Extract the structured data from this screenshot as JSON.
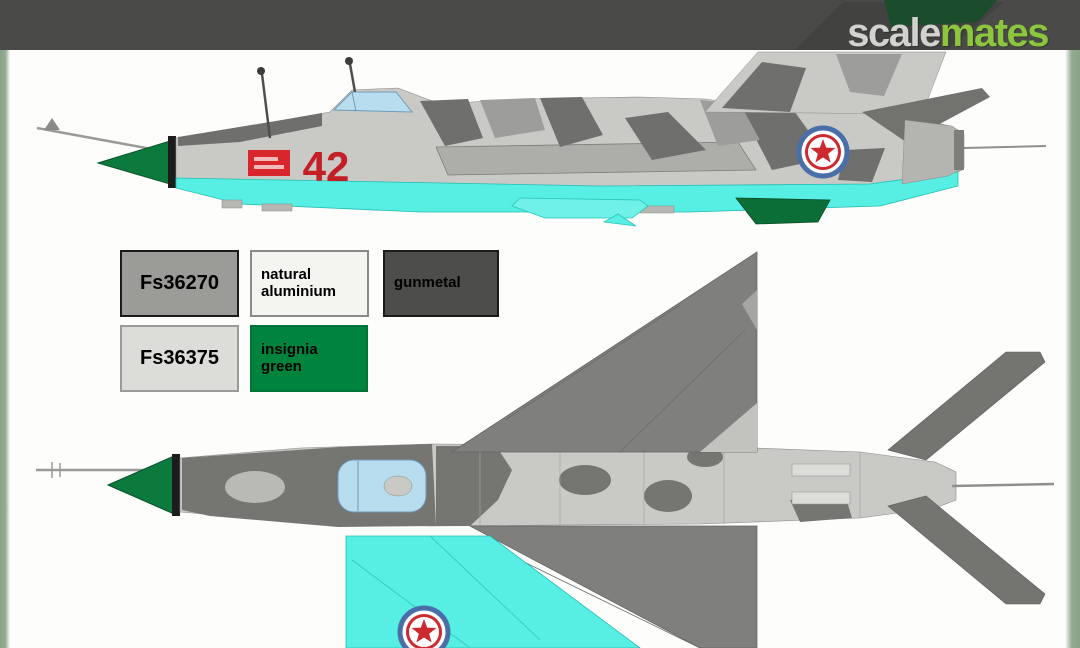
{
  "header": {
    "bar_color": "#4a4a48",
    "logo": {
      "scale": "scale",
      "mates": "mates",
      "scale_color": "#d2d2cf",
      "mates_color": "#8cc63d"
    }
  },
  "artwork": {
    "tactical_number": "42",
    "views": {
      "side": "side profile",
      "top": "top plan view"
    }
  },
  "legend": {
    "swatches": [
      {
        "label": "Fs36270",
        "fill": "#9b9b98",
        "border": "#1b1b1b",
        "text_color": "#000000"
      },
      {
        "label": "natural aluminium",
        "fill": "#f4f4f0",
        "border": "#8a8a88",
        "text_color": "#000000"
      },
      {
        "label": "gunmetal",
        "fill": "#4d4d4b",
        "border": "#1b1b1b",
        "text_color": "#000000"
      },
      {
        "label": "Fs36375",
        "fill": "#dcdcd9",
        "border": "#9a9a98",
        "text_color": "#000000"
      },
      {
        "label": "insignia green",
        "fill": "#00843d",
        "border": "#007338",
        "text_color": "#000000"
      }
    ]
  },
  "palette": {
    "camo_light_gray": "#c9c9c5",
    "camo_dark_gray": "#6f6f6d",
    "underside_turquoise": "#57eee3",
    "nose_fin_green": "#0c7a3d",
    "canopy_blue": "#b7ddef",
    "marking_red": "#d8262c",
    "roundel_blue": "#4a6fa8",
    "side_strip_green": "#8fa78c"
  }
}
